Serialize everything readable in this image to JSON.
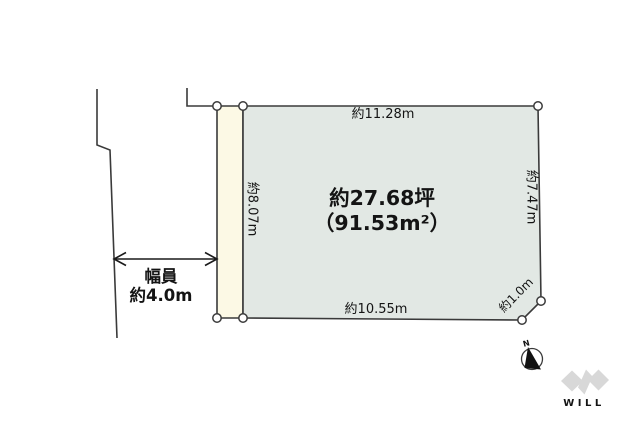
{
  "colors": {
    "plot_fill": "#e2e8e4",
    "road_strip_fill": "#fcf9e5",
    "line": "#3a3a3a",
    "logo": "#d8d8d8"
  },
  "labels": {
    "top_edge": "約11.28m",
    "left_edge": "約8.07m",
    "right_edge": "約7.47m",
    "bottom_edge": "約10.55m",
    "corner_edge": "約1.0m",
    "area_tsubo": "約27.68坪",
    "area_sqm": "（91.53m²）",
    "road_width_title": "幅員",
    "road_width_value": "約4.0m"
  },
  "compass": {
    "north": "N"
  },
  "logo": {
    "text": "WILL"
  }
}
